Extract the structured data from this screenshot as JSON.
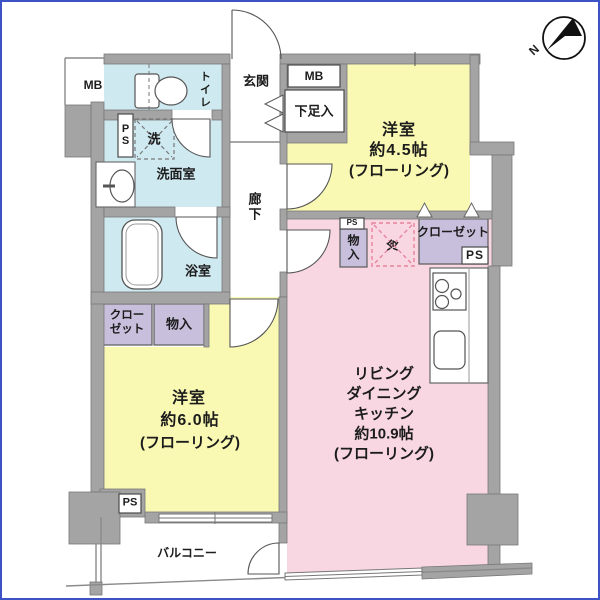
{
  "plan": {
    "rooms": {
      "bedroom45": {
        "name": "洋室",
        "size": "約4.5帖",
        "floor": "(フローリング)"
      },
      "bedroom60": {
        "name": "洋室",
        "size": "約6.0帖",
        "floor": "(フローリング)"
      },
      "ldk": {
        "name1": "リビング",
        "name2": "ダイニング",
        "name3": "キッチン",
        "size": "約10.9帖",
        "floor": "(フローリング)"
      },
      "bath": "浴室",
      "washroom": "洗面室",
      "toilet": "トイレ",
      "entrance": "玄関",
      "hallway": "廊下",
      "balcony": "バルコニー"
    },
    "storage": {
      "closet_right": "クローゼット",
      "closet_left_line1": "クロー",
      "closet_left_line2": "ゼット",
      "storage_mid": "物入",
      "storage_left": "物入",
      "shoe_cabinet": "下足入"
    },
    "labels": {
      "mb": "MB",
      "ps": "PS",
      "laundry": "洗",
      "fridge": "冷"
    },
    "compass": {
      "north": "N"
    }
  },
  "colors": {
    "frame": "#3d53c5",
    "wall": "#a4a4a4",
    "wallStroke": "#787878",
    "yellow": "#faf9b3",
    "pink": "#f8d7e3",
    "blue": "#cfe9f1",
    "lavender": "#c7bfdc",
    "dashPink": "#e8849e"
  }
}
